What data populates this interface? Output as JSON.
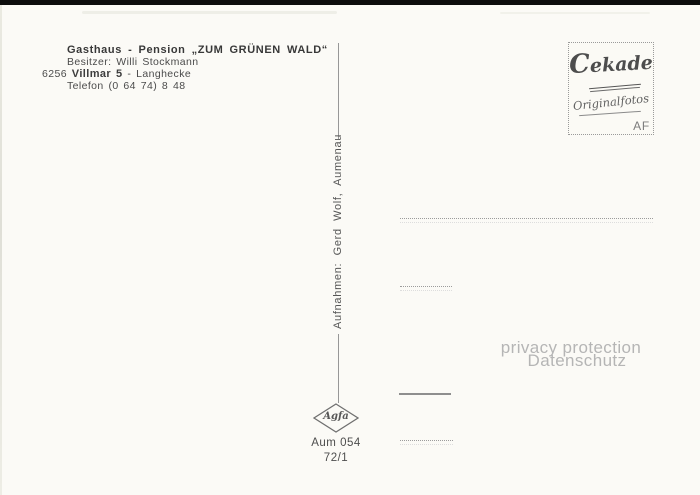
{
  "postcard": {
    "header": {
      "line1": "Gasthaus - Pension „ZUM GRÜNEN WALD“",
      "line2": "Besitzer: Willi Stockmann",
      "line3_prefix": "6256",
      "line3_bold": "Villmar 5",
      "line3_suffix": "- Langhecke",
      "line4": "Telefon (0 64 74) 8 48"
    },
    "stamp_box": {
      "brand": "Cekade",
      "script_line": "Originalfotos",
      "corner_label": "AF"
    },
    "spine": {
      "credit": "Aufnahmen: Gerd Wolf, Aumenau"
    },
    "footer": {
      "film_logo": "Agfa",
      "code_line1": "Aum 054",
      "code_line2": "72/1"
    },
    "watermark": {
      "line1": "privacy protection",
      "line2": "Datenschutz"
    },
    "colors": {
      "paper": "#fbfaf6",
      "scan_edge": "#0d0d0d",
      "ink_dark": "#383838",
      "ink": "#4b4b4b",
      "line_gray": "#9a9a9a",
      "watermark_gray": "#b5b5b5"
    }
  }
}
